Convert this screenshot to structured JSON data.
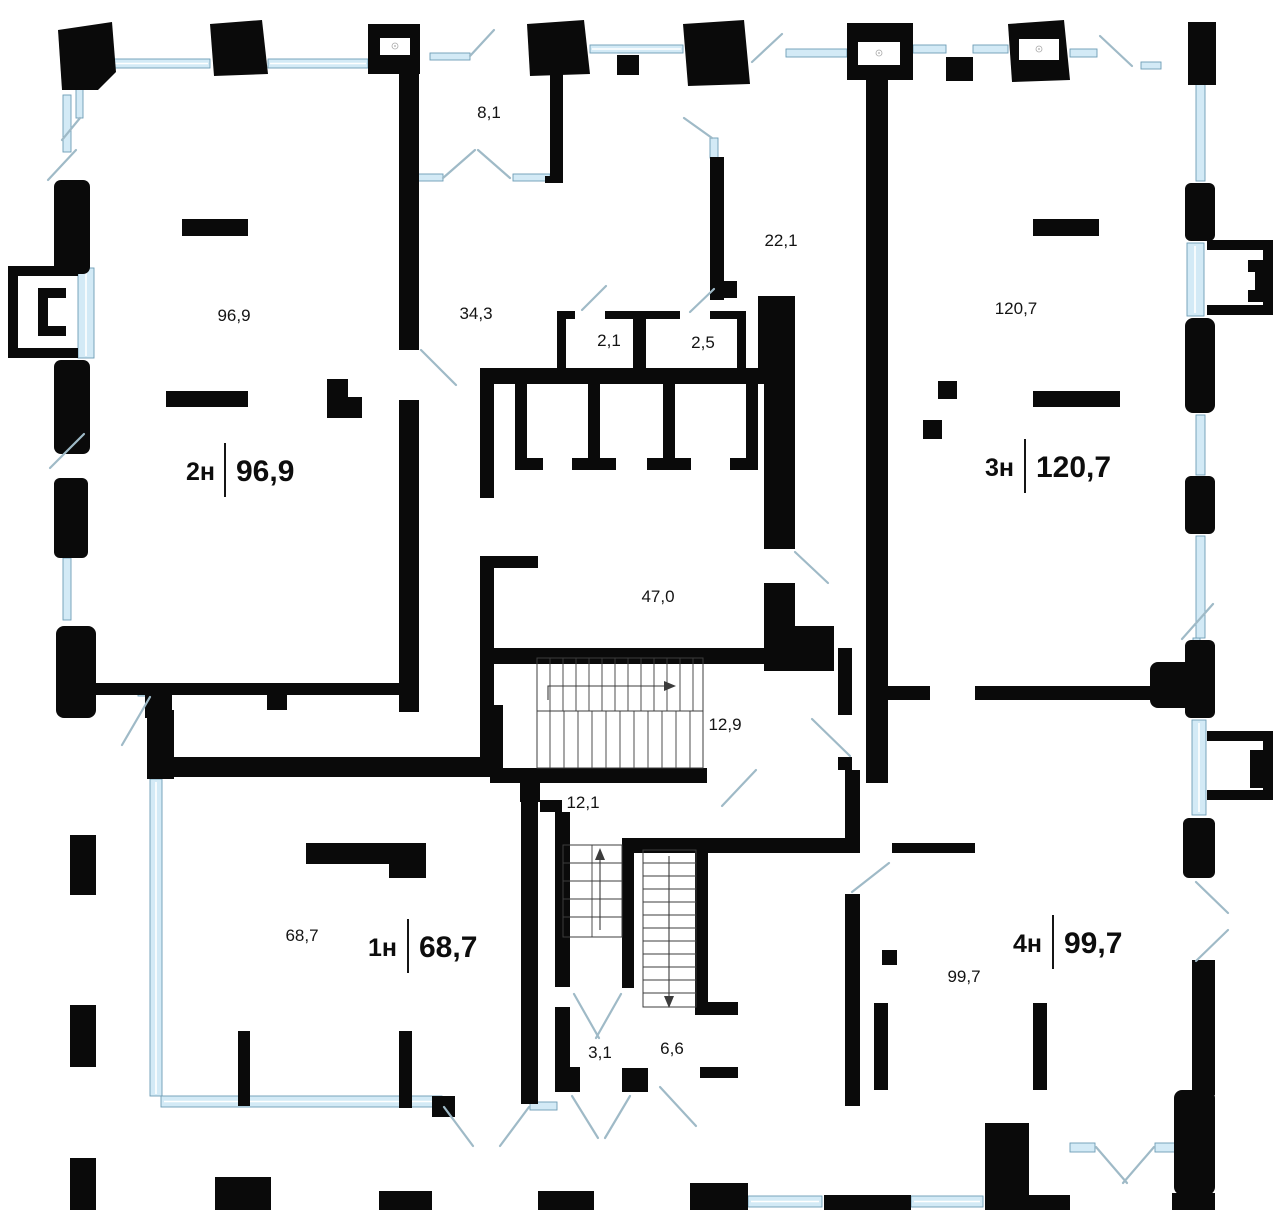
{
  "units": {
    "u2": {
      "name": "2н",
      "area": "96,9"
    },
    "u3": {
      "name": "3н",
      "area": "120,7"
    },
    "u1": {
      "name": "1н",
      "area": "68,7"
    },
    "u4": {
      "name": "4н",
      "area": "99,7"
    }
  },
  "rooms": {
    "r8_1": "8,1",
    "r22_1": "22,1",
    "r34_3": "34,3",
    "r2_1": "2,1",
    "r2_5": "2,5",
    "r47_0": "47,0",
    "r12_9": "12,9",
    "r12_1": "12,1",
    "r3_1": "3,1",
    "r6_6": "6,6"
  },
  "colors": {
    "wall": "#0a0a0a",
    "window_fill": "#d3eaf6",
    "window_stroke": "#6d9db5",
    "door_swing": "#9fbac7",
    "stair_line": "#3c3c3c",
    "text": "#141414"
  }
}
